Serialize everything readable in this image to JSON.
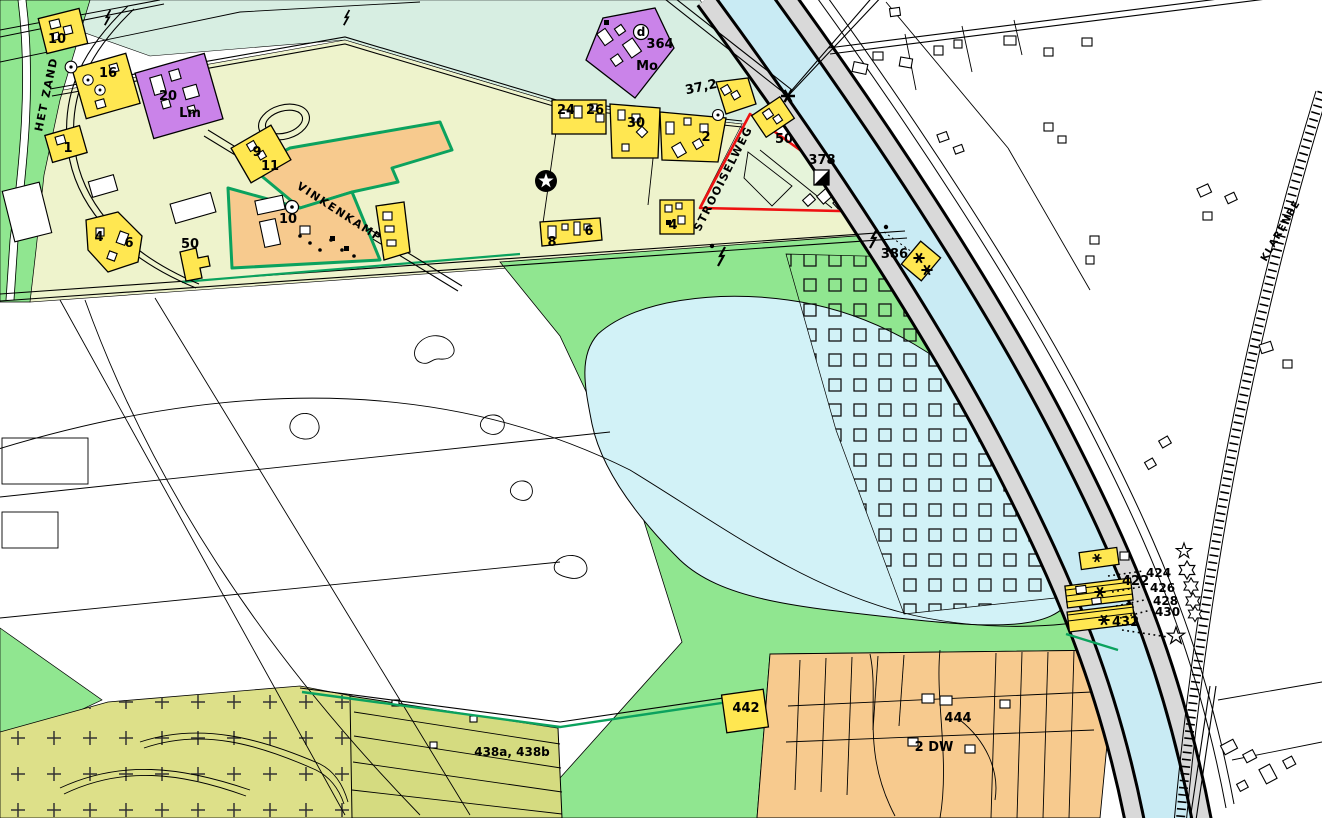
{
  "map": {
    "street_labels": {
      "het_zand": "HET ZAND",
      "vinkenkamp": "VINKENKAMP",
      "strooiselweg": "STROOISELWEG",
      "klarenbeek": "KLARENBE"
    },
    "labels": {
      "p10_topleft": "10",
      "p16": "16",
      "p20": "20",
      "p20_code": "Lm",
      "p1": "1",
      "p9": "9",
      "p11": "11",
      "p_vink": "10",
      "p4_left": "4",
      "p6_left": "6",
      "p50_left": "50",
      "p24": "24",
      "p26": "26",
      "p30": "30",
      "p2": "2",
      "p364": "364",
      "p364_code": "Mo",
      "p364_sym": "d",
      "dist_372": "37,2",
      "p50_stroois": "50",
      "p378": "378",
      "p8": "8",
      "p6_mid": "6",
      "p4_mid": "4",
      "p386": "386",
      "p422": "422",
      "p432": "432",
      "a424": "424",
      "a426": "426",
      "a428": "428",
      "a430": "430",
      "p442": "442",
      "p444": "444",
      "p2dw": "2 DW",
      "p438": "438a, 438b"
    },
    "colors": {
      "zone_farm": "#eef3cc",
      "zone_mint": "#d7eee2",
      "zone_nature_green": "#90e690",
      "zone_forest_olive": "#dde089",
      "zone_parcels_olive": "#d5db80",
      "lake_water": "#d2f2f7",
      "canal_water": "#c9ebf4",
      "canal_bank": "#d9d9d9",
      "parcel_yellow": "#ffe751",
      "parcel_purple": "#ca83e9",
      "parcel_orange": "#f7ca8e",
      "plan_boundary_red": "#ee1111",
      "border_teal": "#0ba25e"
    },
    "symbols": [
      "lightning-icon",
      "asterisk-icon",
      "star-circle-icon",
      "half-square-icon",
      "circle-d-icon",
      "circle-dot-icon",
      "star-outline-icon"
    ]
  }
}
